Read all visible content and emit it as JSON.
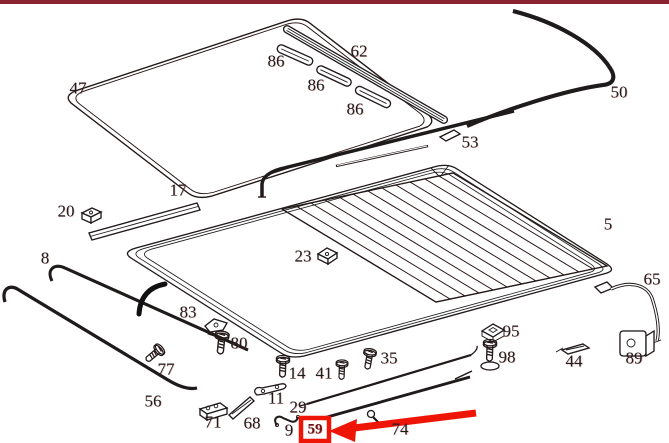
{
  "canvas": {
    "background": "#ffffff",
    "top_border_color": "#8a2433",
    "line_color": "#1c1c1c",
    "accent_fringe_color": "#c62828"
  },
  "labels": [
    {
      "part": "47",
      "text": "47",
      "x": 78,
      "y": 88
    },
    {
      "part": "86",
      "text": "86",
      "x": 276,
      "y": 61
    },
    {
      "part": "62",
      "text": "62",
      "x": 359,
      "y": 51
    },
    {
      "part": "86",
      "text": "86",
      "x": 316,
      "y": 85
    },
    {
      "part": "86",
      "text": "86",
      "x": 355,
      "y": 109
    },
    {
      "part": "50",
      "text": "50",
      "x": 619,
      "y": 92
    },
    {
      "part": "53",
      "text": "53",
      "x": 470,
      "y": 142
    },
    {
      "part": "17",
      "text": "17",
      "x": 178,
      "y": 190
    },
    {
      "part": "20",
      "text": "20",
      "x": 66,
      "y": 211
    },
    {
      "part": "8",
      "text": "8",
      "x": 45,
      "y": 258
    },
    {
      "part": "5",
      "text": "5",
      "x": 608,
      "y": 224
    },
    {
      "part": "23",
      "text": "23",
      "x": 303,
      "y": 256
    },
    {
      "part": "65",
      "text": "65",
      "x": 652,
      "y": 279
    },
    {
      "part": "83",
      "text": "83",
      "x": 188,
      "y": 312
    },
    {
      "part": "80",
      "text": "80",
      "x": 239,
      "y": 343
    },
    {
      "part": "95",
      "text": "95",
      "x": 511,
      "y": 331
    },
    {
      "part": "98",
      "text": "98",
      "x": 507,
      "y": 357
    },
    {
      "part": "77",
      "text": "77",
      "x": 166,
      "y": 369
    },
    {
      "part": "56",
      "text": "56",
      "x": 153,
      "y": 401
    },
    {
      "part": "14",
      "text": "14",
      "x": 297,
      "y": 373
    },
    {
      "part": "41",
      "text": "41",
      "x": 324,
      "y": 373
    },
    {
      "part": "35",
      "text": "35",
      "x": 389,
      "y": 358
    },
    {
      "part": "44",
      "text": "44",
      "x": 574,
      "y": 361
    },
    {
      "part": "89",
      "text": "89",
      "x": 634,
      "y": 358
    },
    {
      "part": "71",
      "text": "71",
      "x": 213,
      "y": 422
    },
    {
      "part": "68",
      "text": "68",
      "x": 252,
      "y": 423
    },
    {
      "part": "11",
      "text": "11",
      "x": 276,
      "y": 398
    },
    {
      "part": "29",
      "text": "29",
      "x": 298,
      "y": 407
    },
    {
      "part": "9",
      "text": "9",
      "x": 289,
      "y": 430
    },
    {
      "part": "74",
      "text": "74",
      "x": 400,
      "y": 429
    }
  ],
  "highlight": {
    "label": "59",
    "label_pos": {
      "x": 315,
      "y": 430
    },
    "box_color": "#ee1507",
    "arrow_color": "#ee1507",
    "annotation": "red box around part number 59 with red arrow pointing to it"
  }
}
